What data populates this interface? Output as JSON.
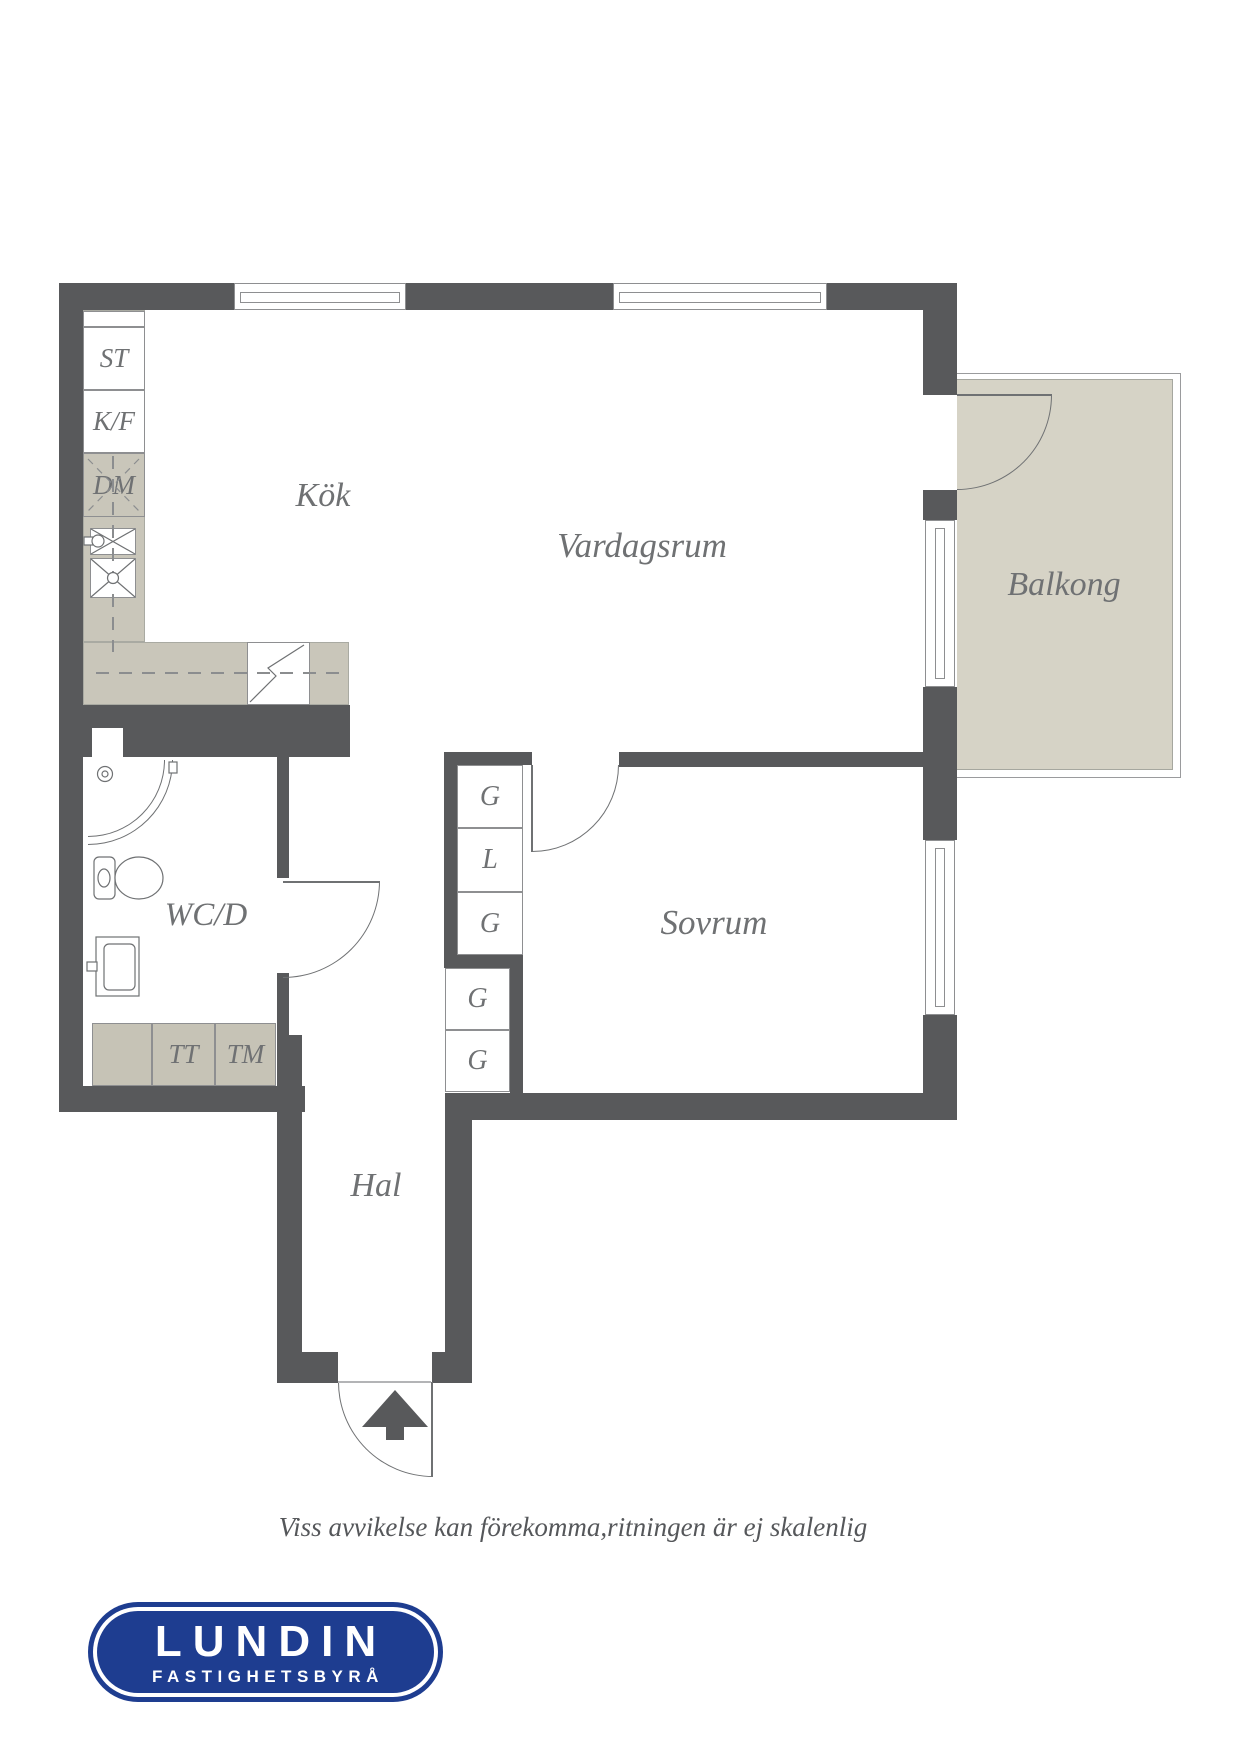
{
  "colors": {
    "wall": "#58595b",
    "beige": "#c9c6ba",
    "beige2": "#c6c3b6",
    "balcony": "#d6d3c6",
    "line": "#6f7173",
    "thin": "#8e8f91",
    "label": "#6f7173",
    "blue": "#1e3d90"
  },
  "rooms": {
    "kitchen": "Kök",
    "living": "Vardagsrum",
    "balcony": "Balkong",
    "wc": "WC/D",
    "bedroom": "Sovrum",
    "hall": "Hal"
  },
  "kitchen_units": {
    "st": "ST",
    "kf": "K/F",
    "dm": "DM"
  },
  "laundry_units": {
    "tt": "TT",
    "tm": "TM"
  },
  "closets": {
    "upper": [
      "G",
      "L",
      "G"
    ],
    "lower": [
      "G",
      "G"
    ]
  },
  "footer": {
    "disclaimer": "Viss avvikelse kan förekomma,ritningen är ej skalenlig"
  },
  "logo": {
    "name": "LUNDIN",
    "tagline": "FASTIGHETSBYRÅ"
  }
}
